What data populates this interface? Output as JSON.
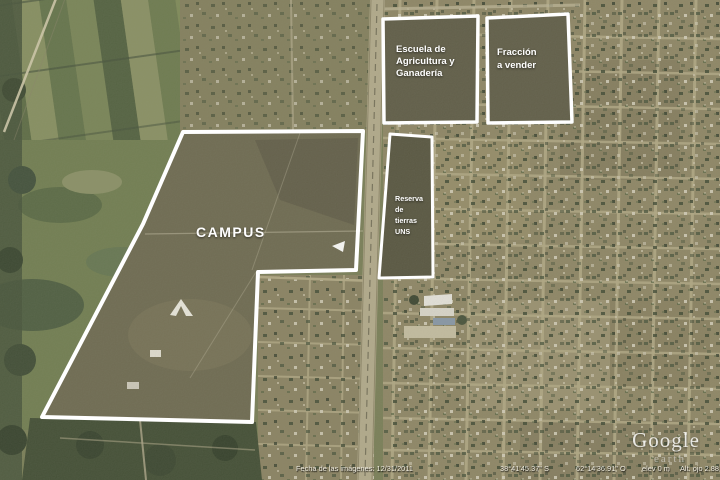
{
  "annotations": {
    "campus": {
      "label": "CAMPUS"
    },
    "escuela": {
      "lines": [
        "Escuela de",
        "Agricultura y",
        "Ganadería"
      ]
    },
    "fraccion": {
      "lines": [
        "Fracción",
        "a vender"
      ]
    },
    "reserva": {
      "lines": [
        "Reserva",
        "de",
        "tierras",
        "UNS"
      ]
    }
  },
  "watermark": {
    "brand": "Google",
    "product": "earth"
  },
  "status_bar": {
    "imagery_date": "Fecha de las imágenes: 12/31/2011",
    "latitude": "38°41'45.37\" S",
    "longitude": "62°14'36.91\" O",
    "elevation": "elev 0 m",
    "eye_altitude": "Alt. ojo 2.88 km"
  },
  "colors": {
    "annotation_outline": "#ffffff",
    "annotation_text": "#ffffff",
    "status_text": "#efece0",
    "farmland_green": "#6b7a4c",
    "urban_tan": "#8f8765",
    "street": "#b3aa85"
  }
}
